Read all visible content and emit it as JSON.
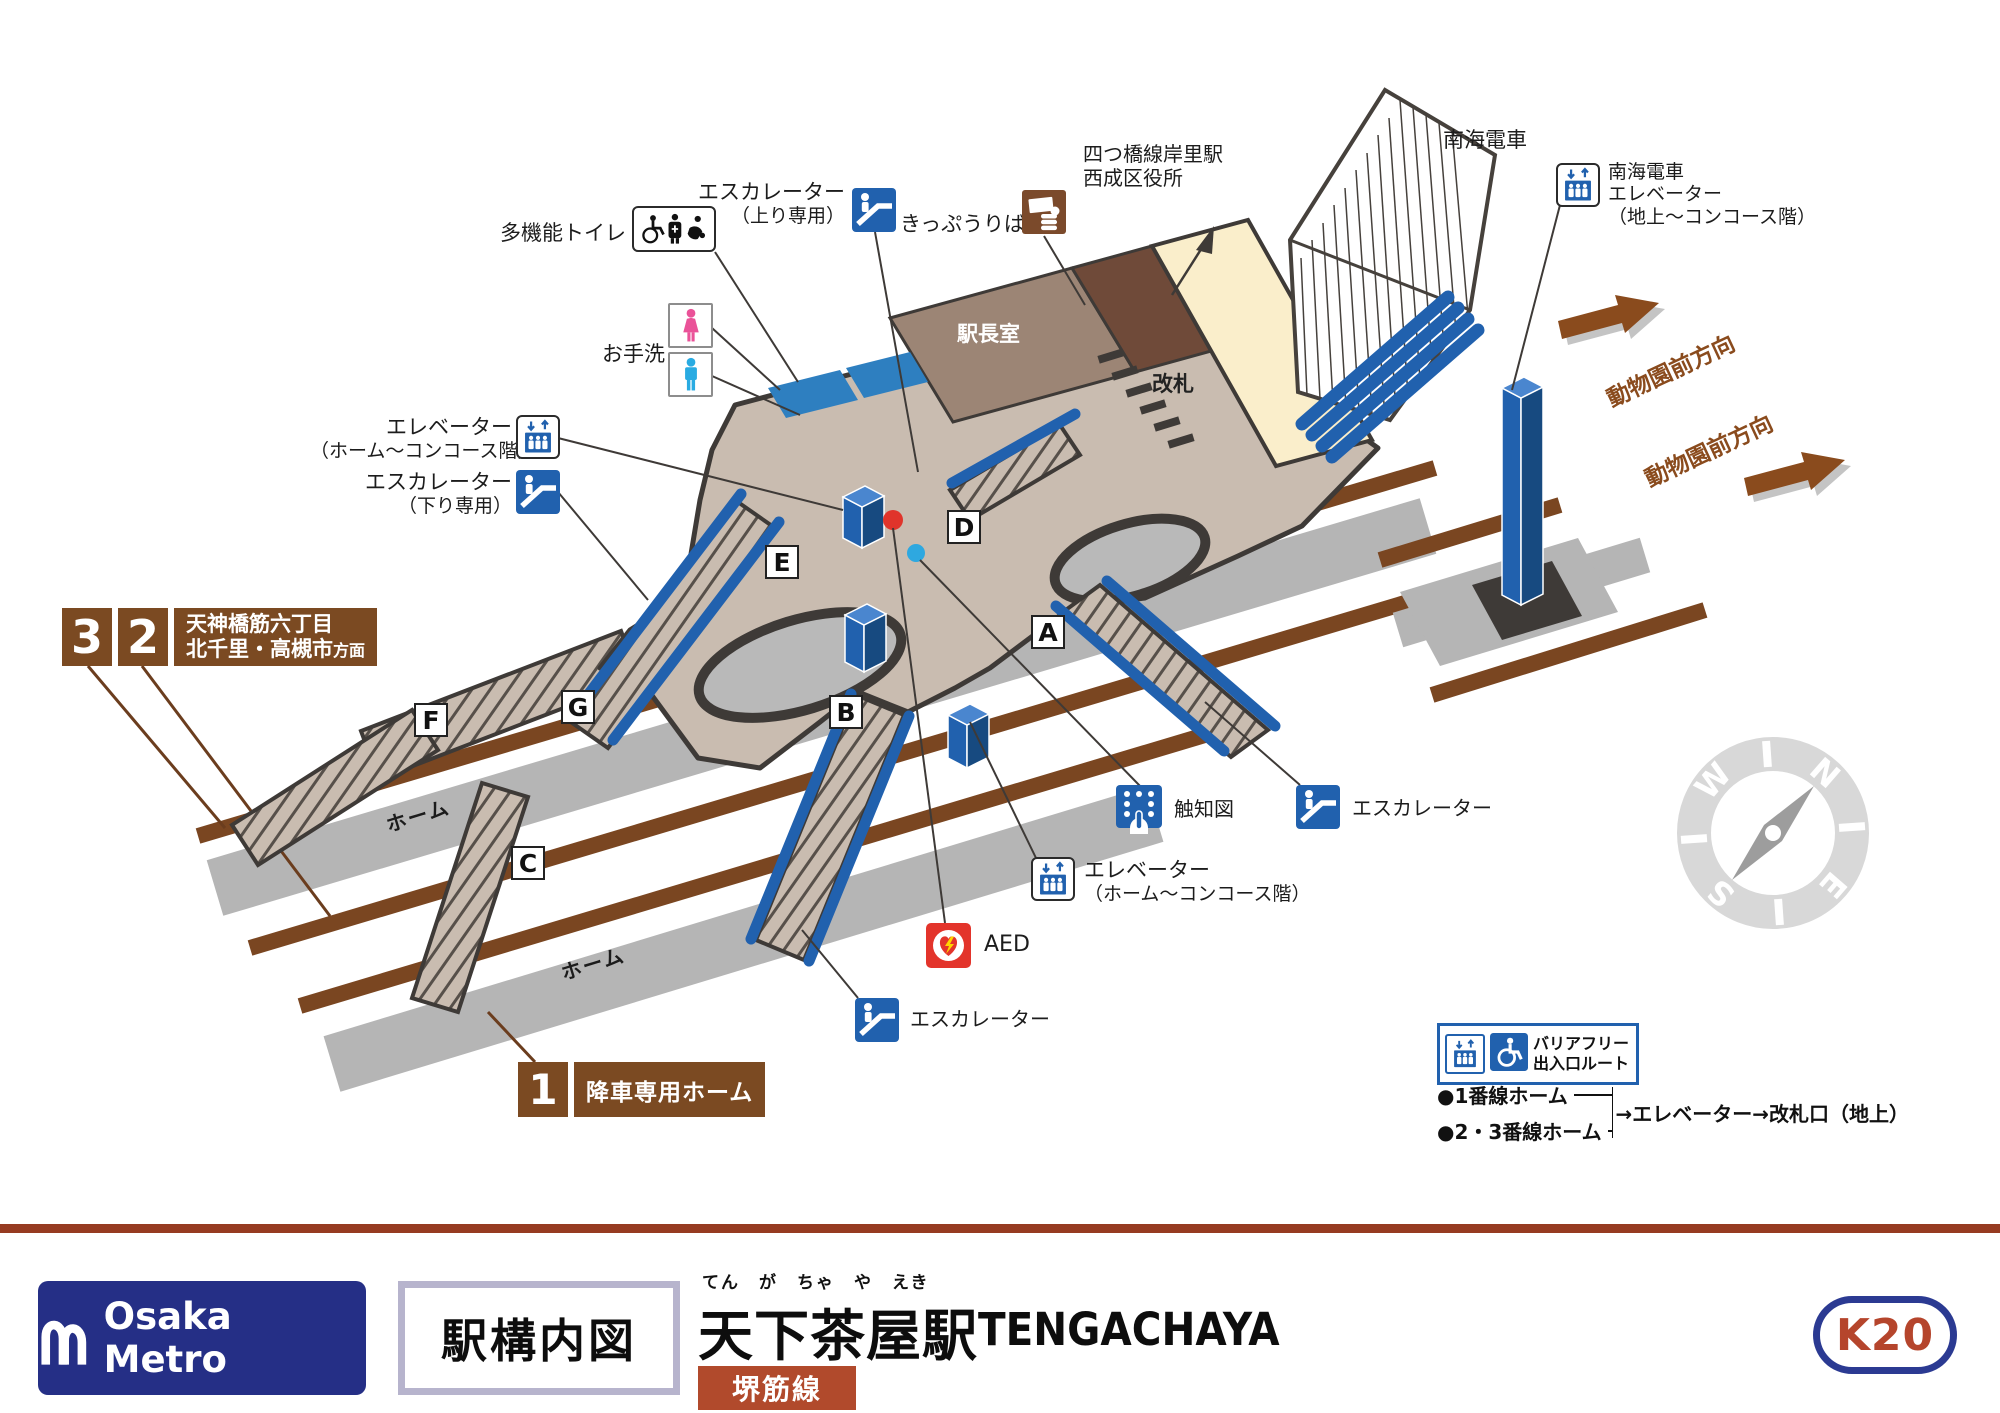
{
  "colors": {
    "accent_blue": "#2161ae",
    "badge_brown": "#7b4a22",
    "track_brown": "#7a4621",
    "floor_tan": "#c9bcb0",
    "gate_cream": "#faeecb",
    "platform_gray": "#b5b5b5",
    "brand_navy": "#252f86",
    "line_color": "#b14a2c",
    "aed_red": "#e3342b"
  },
  "icons": {
    "escalator": "escalator-icon",
    "elevator": "elevator-icon",
    "wheelchair": "wheelchair-icon",
    "ticket_machine": "ticket-machine-icon",
    "tactile": "tactile-map-icon",
    "aed": "aed-icon",
    "female": "female-icon",
    "male": "male-icon",
    "multifunction_toilet": "multifunction-toilet-icon",
    "compass": "compass-icon",
    "direction_arrow": "direction-arrow-icon"
  },
  "map": {
    "facility_labels": {
      "multifunction_toilet": "多機能トイレ",
      "escalator_up_1": "エスカレーター",
      "escalator_up_2": "（上り専用）",
      "ticket_office": "きっぷうりば",
      "yotsubashi_1": "四つ橋線岸里駅",
      "yotsubashi_2": "西成区役所",
      "nankai": "南海電車",
      "nankai_elev_1": "南海電車",
      "nankai_elev_2": "エレベーター",
      "nankai_elev_3": "（地上～コンコース階）",
      "zoo_dir_1": "動物園前方向",
      "zoo_dir_2": "動物園前方向",
      "station_master_room": "駅長室",
      "ticket_gate": "改札",
      "restroom": "お手洗",
      "elevator_left_1": "エレベーター",
      "elevator_left_2": "（ホーム～コンコース階）",
      "escalator_down_1": "エスカレーター",
      "escalator_down_2": "（下り専用）",
      "tactile_map": "触知図",
      "escalator_right": "エスカレーター",
      "elevator_center_1": "エレベーター",
      "elevator_center_2": "（ホーム～コンコース階）",
      "aed": "AED",
      "escalator_bottom": "エスカレーター",
      "platform_upper": "ホーム",
      "platform_lower": "ホーム"
    },
    "exits": {
      "a": "A",
      "b": "B",
      "c": "C",
      "d": "D",
      "e": "E",
      "f": "F",
      "g": "G"
    },
    "badge_32": {
      "num_3": "3",
      "num_2": "2",
      "dest_line1": "天神橋筋六丁目",
      "dest_line2": "北千里・高槻市",
      "dest_suffix": "方面"
    },
    "badge_1": {
      "num": "1",
      "label": "降車専用ホーム"
    },
    "compass": {
      "n": "N",
      "e": "E",
      "s": "S",
      "w": "W"
    },
    "barrier_free": {
      "title_1": "バリアフリー",
      "title_2": "出入口ルート",
      "route_1": "●1番線ホーム",
      "route_2": "●2・3番線ホーム",
      "route_dest": "→エレベーター→改札口（地上）"
    }
  },
  "footer": {
    "brand": "Osaka Metro",
    "map_title": "駅構内図",
    "furigana": "てん　が　ちゃ　や　えき",
    "station_ja": "天下茶屋駅",
    "station_en": "TENGACHAYA",
    "line_name": "堺筋線",
    "station_code": "K20"
  }
}
